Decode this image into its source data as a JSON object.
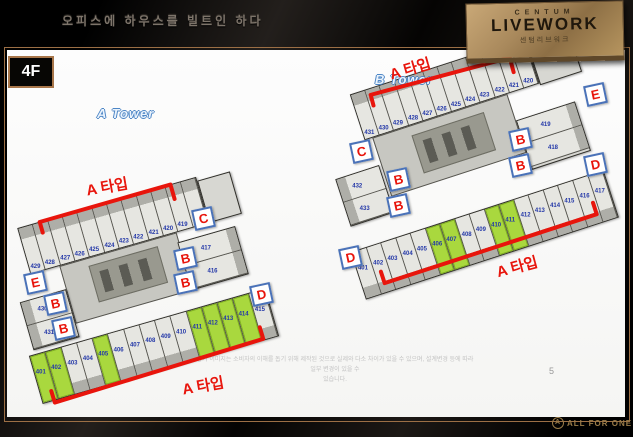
{
  "header": {
    "tagline": "오피스에 하우스를 빌트인 하다",
    "logo": {
      "top": "CENTUM",
      "main": "LIVEWORK",
      "sub": "센텀리브워크"
    }
  },
  "slide": {
    "floor_badge": "4F",
    "page_number": "5",
    "disclaimer_line1": "상기 이미지는 소비자의 이해를 돕기 위해 제작된 것으로 실제와 다소 차이가 있을 수 있으며, 설계변경 등에 따라 일부 변경이 있을 수",
    "disclaimer_line2": "있습니다.",
    "footer_brand": "ALL FOR ONE",
    "footer_icon_glyph": "A"
  },
  "colors": {
    "accent_red": "#e8150c",
    "unit_green": "#a9d83e",
    "unit_number_blue": "#2438a8",
    "badge_border_blue": "#4a72b8",
    "frame_tan": "#9c6f45",
    "logo_gold": "#b6955f"
  },
  "towers": [
    {
      "name": "A Tower",
      "top_units": [
        {
          "n": "429"
        },
        {
          "n": "428"
        },
        {
          "n": "427"
        },
        {
          "n": "426"
        },
        {
          "n": "425"
        },
        {
          "n": "424"
        },
        {
          "n": "423"
        },
        {
          "n": "422"
        },
        {
          "n": "421"
        },
        {
          "n": "420"
        },
        {
          "n": "419"
        },
        {
          "n": "418"
        }
      ],
      "bottom_units": [
        {
          "n": "401",
          "g": 1
        },
        {
          "n": "402",
          "g": 1
        },
        {
          "n": "403"
        },
        {
          "n": "404"
        },
        {
          "n": "405",
          "g": 1
        },
        {
          "n": "406"
        },
        {
          "n": "407"
        },
        {
          "n": "408"
        },
        {
          "n": "409"
        },
        {
          "n": "410"
        },
        {
          "n": "411",
          "g": 1
        },
        {
          "n": "412",
          "g": 1
        },
        {
          "n": "413",
          "g": 1
        },
        {
          "n": "414",
          "g": 1
        },
        {
          "n": "415"
        }
      ],
      "left_units": [
        {
          "n": "430"
        },
        {
          "n": "431"
        }
      ],
      "right_units": [
        {
          "n": "417"
        },
        {
          "n": "416"
        }
      ],
      "badges": [
        "E",
        "B",
        "B",
        "C",
        "B",
        "B",
        "D"
      ],
      "type_labels": [
        "A 타입",
        "A 타입"
      ]
    },
    {
      "name": "B Tower",
      "top_units": [
        {
          "n": "431"
        },
        {
          "n": "430"
        },
        {
          "n": "429"
        },
        {
          "n": "428"
        },
        {
          "n": "427"
        },
        {
          "n": "426"
        },
        {
          "n": "425"
        },
        {
          "n": "424"
        },
        {
          "n": "423"
        },
        {
          "n": "422"
        },
        {
          "n": "421"
        },
        {
          "n": "420"
        }
      ],
      "bottom_units": [
        {
          "n": "401"
        },
        {
          "n": "402"
        },
        {
          "n": "403"
        },
        {
          "n": "404"
        },
        {
          "n": "405"
        },
        {
          "n": "406",
          "g": 1
        },
        {
          "n": "407",
          "g": 1
        },
        {
          "n": "408"
        },
        {
          "n": "409"
        },
        {
          "n": "410",
          "g": 1
        },
        {
          "n": "411",
          "g": 1
        },
        {
          "n": "412"
        },
        {
          "n": "413"
        },
        {
          "n": "414"
        },
        {
          "n": "415"
        },
        {
          "n": "416"
        },
        {
          "n": "417"
        }
      ],
      "left_units": [
        {
          "n": "432"
        },
        {
          "n": "433"
        }
      ],
      "right_units": [
        {
          "n": "419"
        },
        {
          "n": "418"
        }
      ],
      "badges": [
        "C",
        "B",
        "B",
        "E",
        "D",
        "B",
        "B",
        "D"
      ],
      "type_labels": [
        "A 타입",
        "A 타입"
      ]
    }
  ]
}
